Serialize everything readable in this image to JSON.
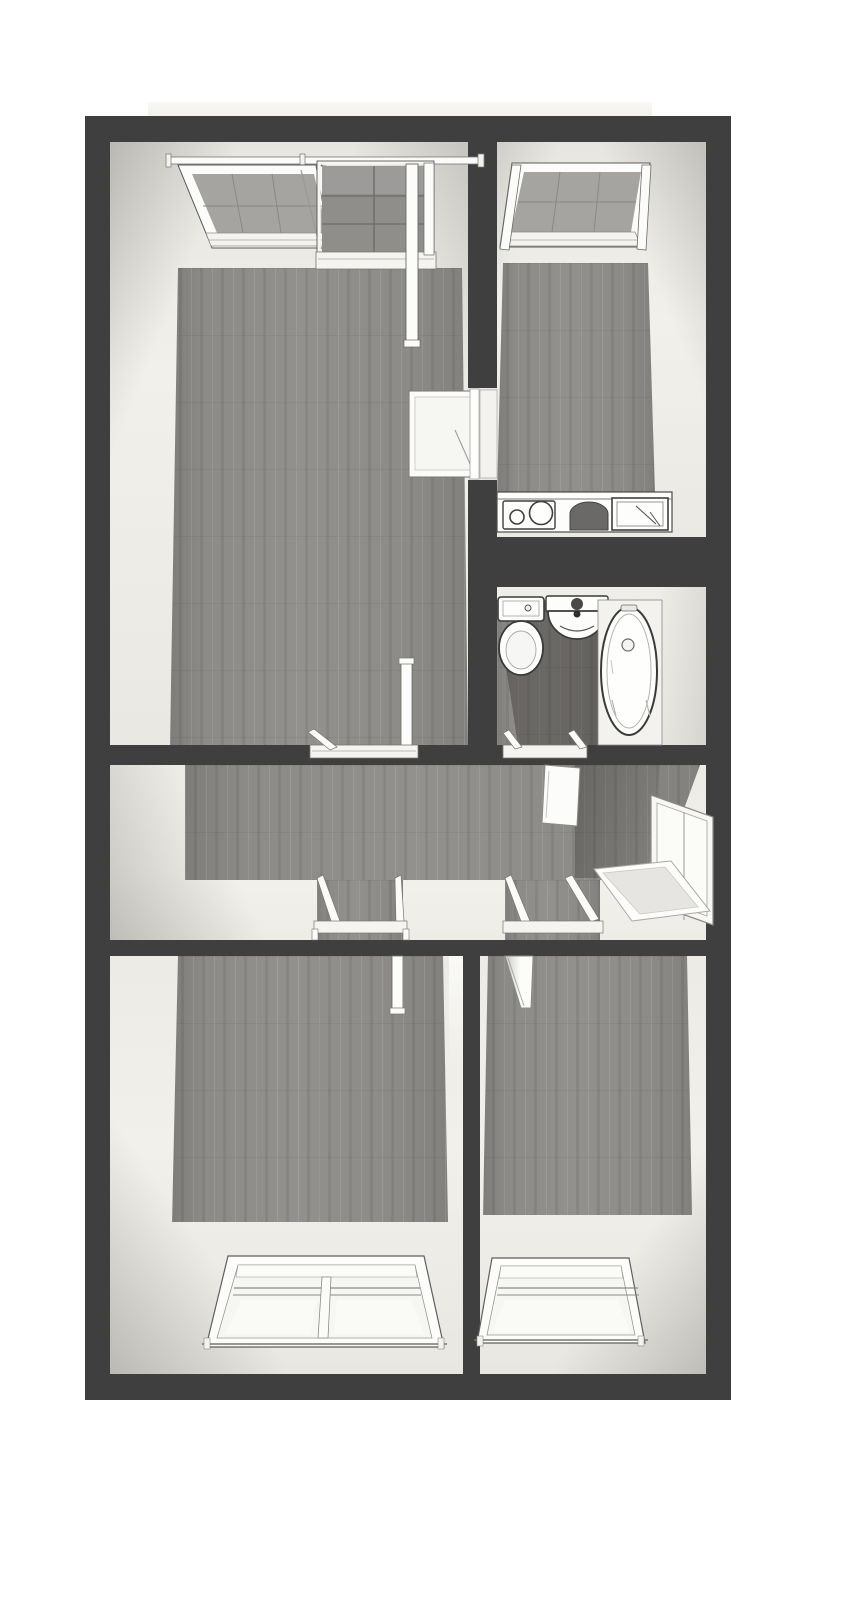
{
  "image": {
    "kind": "3d-floor-plan-top-down-render",
    "width": 867,
    "height": 1600,
    "visible_text": "none"
  },
  "palette": {
    "background": "#ffffff",
    "wall_dark": "#403f3f",
    "cream_light": "#f1f0ea",
    "cream_mid": "#e7e5df",
    "wood": "#8d8b88",
    "wood_dark": "#6f6d69",
    "tile": "#908e8b",
    "grout": "#6e6c69",
    "fixture_white": "#fcfcfa",
    "outline": "#3a3a39",
    "glass": "#f7f7f4",
    "frame_gray": "#8a8a88"
  },
  "floorplan": {
    "style": "dark gray walls, gray wood plank floors, cream wall faces in perspective",
    "rooms": [
      {
        "name": "living-room",
        "position": "top-left",
        "features": [
          "open-casement-window",
          "balcony-door-with-tiled-balcony",
          "open-door-to-kitchen",
          "open-door-to-hallway",
          "wood-floor"
        ]
      },
      {
        "name": "kitchen",
        "position": "top-right",
        "features": [
          "open-casement-window",
          "counter-with-cooktop",
          "counter-sink-with-drainer",
          "wood-floor"
        ]
      },
      {
        "name": "bathroom",
        "position": "middle-right",
        "features": [
          "toilet-with-cistern",
          "round-washbasin",
          "bathtub",
          "open-door-to-hallway",
          "wood-floor"
        ]
      },
      {
        "name": "hallway",
        "position": "middle",
        "features": [
          "entrance-door-open",
          "doormat",
          "doorway-to-living-room",
          "doorway-to-bathroom",
          "doorway-to-bedroom-left",
          "doorway-to-bedroom-right",
          "wood-floor"
        ]
      },
      {
        "name": "bedroom-left",
        "position": "bottom-left",
        "features": [
          "double-window",
          "open-door-to-hallway",
          "wood-floor"
        ]
      },
      {
        "name": "bedroom-right",
        "position": "bottom-right",
        "features": [
          "single-window",
          "open-door-to-hallway",
          "wood-floor"
        ]
      }
    ],
    "exterior": {
      "balcony_strip_visible_above_top_wall": true
    }
  }
}
